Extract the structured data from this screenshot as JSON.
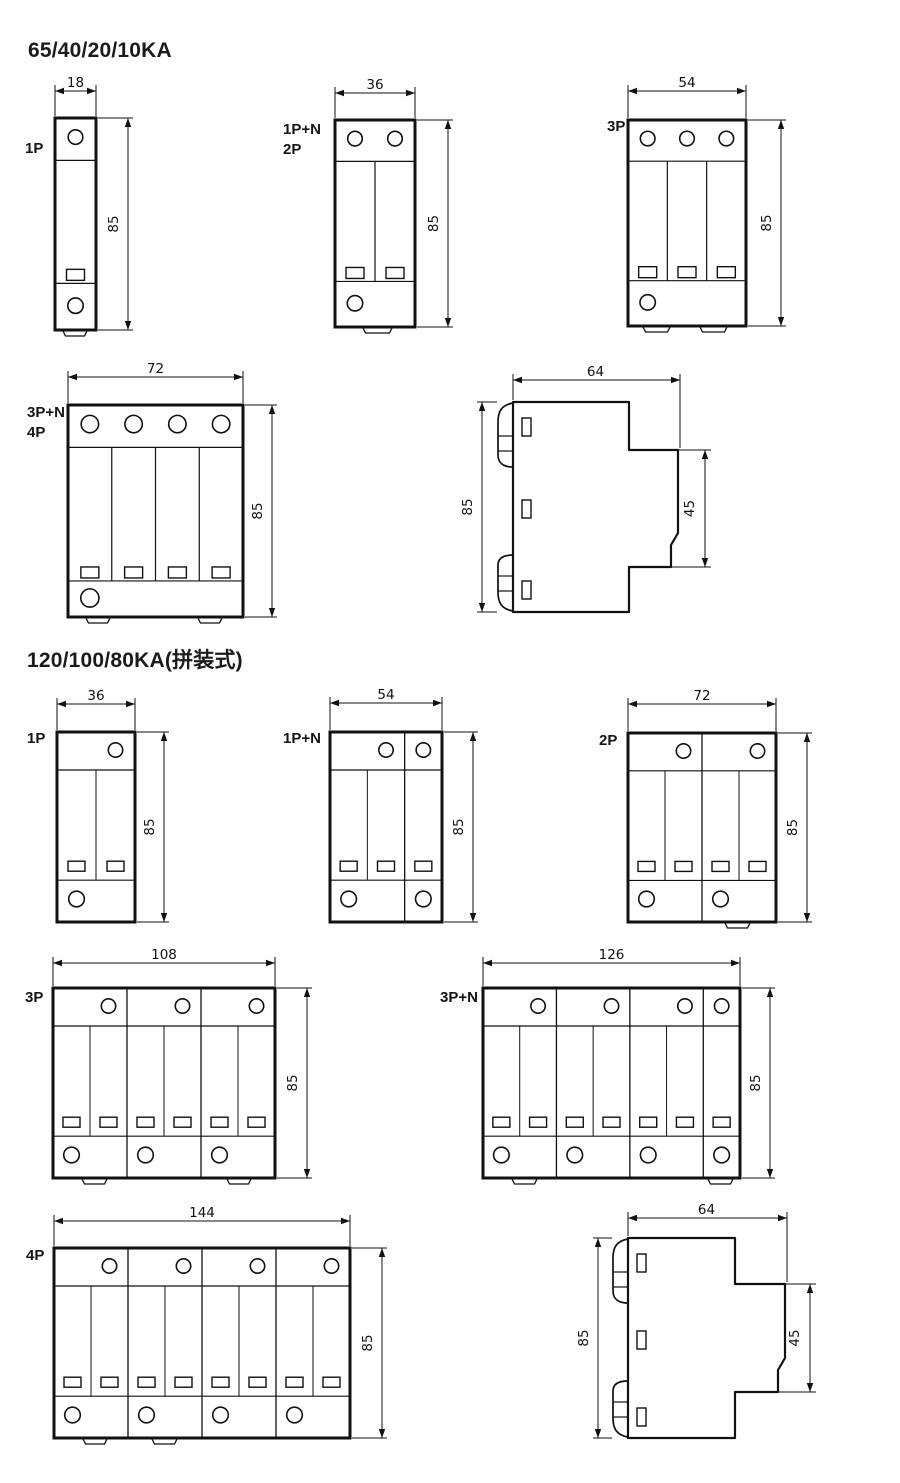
{
  "page": {
    "background": "#ffffff",
    "line_color": "#111111"
  },
  "sections": [
    {
      "title": "65/40/20/10KA",
      "figures": [
        {
          "id": "ka65-1p",
          "view": "front",
          "label_lines": [
            "1P"
          ],
          "poles": 1,
          "dim_width": "18",
          "dim_height": "85"
        },
        {
          "id": "ka65-1pn-2p",
          "view": "front",
          "label_lines": [
            "1P+N",
            "2P"
          ],
          "poles": 2,
          "dim_width": "36",
          "dim_height": "85"
        },
        {
          "id": "ka65-3p",
          "view": "front",
          "label_lines": [
            "3P"
          ],
          "poles": 3,
          "dim_width": "54",
          "dim_height": "85"
        },
        {
          "id": "ka65-3pn-4p",
          "view": "front",
          "label_lines": [
            "3P+N",
            "4P"
          ],
          "poles": 4,
          "dim_width": "72",
          "dim_height": "85"
        },
        {
          "id": "ka65-side",
          "view": "side",
          "dim_width": "64",
          "dim_height": "85",
          "dim_depth": "45"
        }
      ]
    },
    {
      "title": "120/100/80KA(拼装式)",
      "figures": [
        {
          "id": "ka120-1p",
          "view": "front",
          "label_lines": [
            "1P"
          ],
          "modules": [
            2
          ],
          "dim_width": "36",
          "dim_height": "85"
        },
        {
          "id": "ka120-1pn",
          "view": "front",
          "label_lines": [
            "1P+N"
          ],
          "modules": [
            2,
            1
          ],
          "dim_width": "54",
          "dim_height": "85"
        },
        {
          "id": "ka120-2p",
          "view": "front",
          "label_lines": [
            "2P"
          ],
          "modules": [
            2,
            2
          ],
          "dim_width": "72",
          "dim_height": "85"
        },
        {
          "id": "ka120-3p",
          "view": "front",
          "label_lines": [
            "3P"
          ],
          "modules": [
            2,
            2,
            2
          ],
          "dim_width": "108",
          "dim_height": "85"
        },
        {
          "id": "ka120-3pn",
          "view": "front",
          "label_lines": [
            "3P+N"
          ],
          "modules": [
            2,
            2,
            2,
            1
          ],
          "dim_width": "126",
          "dim_height": "85"
        },
        {
          "id": "ka120-4p",
          "view": "front",
          "label_lines": [
            "4P"
          ],
          "modules": [
            2,
            2,
            2,
            2
          ],
          "dim_width": "144",
          "dim_height": "85"
        },
        {
          "id": "ka120-side",
          "view": "side",
          "dim_width": "64",
          "dim_height": "85",
          "dim_depth": "45"
        }
      ]
    }
  ]
}
